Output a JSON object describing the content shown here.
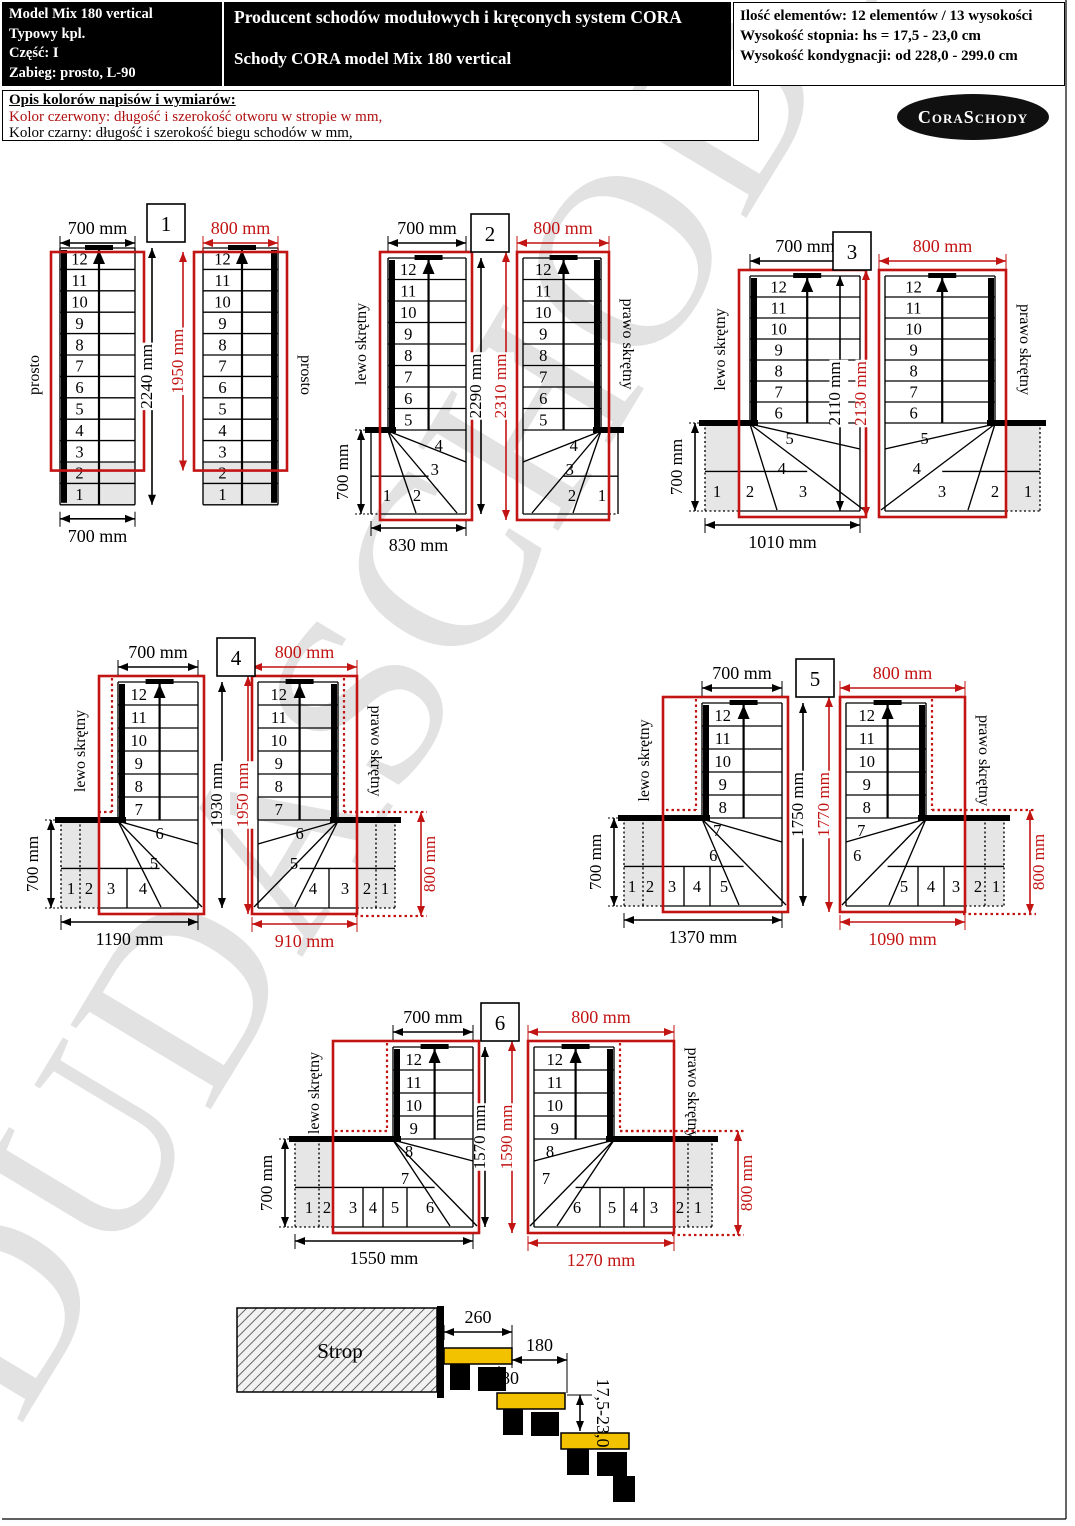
{
  "header": {
    "left_box": {
      "lines": [
        "Model Mix 180 vertical",
        "Typowy kpl.",
        "Część: I",
        "Zabieg: prosto, L-90"
      ]
    },
    "center_box": {
      "line1": "Producent schodów modułowych i kręconych system CORA",
      "line2": "Schody CORA model Mix 180 vertical"
    },
    "right_box": {
      "lines": [
        "Ilość elementów: 12 elementów / 13 wysokości",
        "Wysokość stopnia:  hs = 17,5 - 23,0 cm",
        "Wysokość kondygnacji: od 228,0 - 299.0 cm"
      ]
    }
  },
  "legend": {
    "title": "Opis kolorów napisów i wymiarów:",
    "red_line": "Kolor czerwony:  długość i szerokość otworu w stropie w mm,",
    "black_line": "Kolor czarny:  długość i szerokość biegu schodów w mm,"
  },
  "logo": {
    "text": "CoraSchody"
  },
  "watermark": {
    "text": "DUDASCHODY"
  },
  "colors": {
    "red": "#c31414",
    "black": "#000000",
    "gray_fill": "#e6e6e6",
    "tread_yellow": "#f2c200",
    "watermark_gray": "#c7c7c7"
  },
  "diagrams": [
    {
      "number": "1",
      "steps_straight": [
        "12",
        "11",
        "10",
        "9",
        "8",
        "7",
        "6",
        "5",
        "4",
        "3",
        "2",
        "1"
      ],
      "left": {
        "turn_label": "prosto",
        "top_dim": "700 mm",
        "height_dim": "2240 mm",
        "bottom_dim": "700 mm"
      },
      "right": {
        "turn_label": "prosto",
        "top_dim": "800 mm",
        "height_dim": "1950 mm"
      }
    },
    {
      "number": "2",
      "steps_straight": [
        "12",
        "11",
        "10",
        "9",
        "8",
        "7",
        "6",
        "5"
      ],
      "steps_fan": [
        "4",
        "3"
      ],
      "steps_winder": [
        "1",
        "2"
      ],
      "left": {
        "turn_label": "lewo skrętny",
        "top_dim": "700 mm",
        "height_dim": "2290 mm",
        "bottom_dim": "830 mm",
        "side_dim": "700 mm"
      },
      "right": {
        "turn_label": "prawo skrętny",
        "top_dim": "800 mm",
        "height_dim": "2310 mm"
      }
    },
    {
      "number": "3",
      "steps_straight": [
        "12",
        "11",
        "10",
        "9",
        "8",
        "7",
        "6"
      ],
      "steps_fan": [
        "5",
        "4"
      ],
      "steps_winder": [
        "1",
        "2",
        "3"
      ],
      "left": {
        "turn_label": "lewo skrętny",
        "top_dim": "700 mm",
        "height_dim": "2110 mm",
        "bottom_dim": "1010 mm",
        "side_dim": "700 mm"
      },
      "right": {
        "turn_label": "prawo skrętny",
        "top_dim": "800 mm",
        "height_dim": "2130 mm"
      }
    },
    {
      "number": "4",
      "steps_straight": [
        "12",
        "11",
        "10",
        "9",
        "8",
        "7"
      ],
      "steps_fan": [
        "6",
        "5"
      ],
      "steps_winder": [
        "1",
        "2",
        "3",
        "4"
      ],
      "left": {
        "turn_label": "lewo skrętny",
        "top_dim": "700 mm",
        "height_dim": "1930 mm",
        "bottom_dim": "1190 mm",
        "side_dim": "700 mm"
      },
      "right": {
        "turn_label": "prawo skrętny",
        "top_dim": "800 mm",
        "height_dim": "1950 mm",
        "bottom_dim": "910 mm",
        "side_dim": "800 mm"
      }
    },
    {
      "number": "5",
      "steps_straight": [
        "12",
        "11",
        "10",
        "9",
        "8"
      ],
      "steps_fan": [
        "7",
        "6"
      ],
      "steps_winder": [
        "1",
        "2",
        "3",
        "4",
        "5"
      ],
      "left": {
        "turn_label": "lewo skrętny",
        "top_dim": "700 mm",
        "height_dim": "1750 mm",
        "bottom_dim": "1370 mm",
        "side_dim": "700 mm"
      },
      "right": {
        "turn_label": "prawo skrętny",
        "top_dim": "800 mm",
        "height_dim": "1770 mm",
        "bottom_dim": "1090 mm",
        "side_dim": "800 mm"
      }
    },
    {
      "number": "6",
      "steps_straight": [
        "12",
        "11",
        "10",
        "9"
      ],
      "steps_fan": [
        "8",
        "7"
      ],
      "steps_winder": [
        "1",
        "2",
        "3",
        "4",
        "5",
        "6"
      ],
      "left": {
        "turn_label": "lewo skrętny",
        "top_dim": "700 mm",
        "height_dim": "1570 mm",
        "bottom_dim": "1550 mm",
        "side_dim": "700 mm"
      },
      "right": {
        "turn_label": "prawo skrętny",
        "top_dim": "800 mm",
        "height_dim": "1590 mm",
        "bottom_dim": "1270 mm",
        "side_dim": "800 mm"
      }
    }
  ],
  "cross_section": {
    "slab_label": "Strop",
    "tread_depth": "260",
    "going": "180",
    "overlap": "80",
    "riser_height": "17,5-23,0"
  }
}
